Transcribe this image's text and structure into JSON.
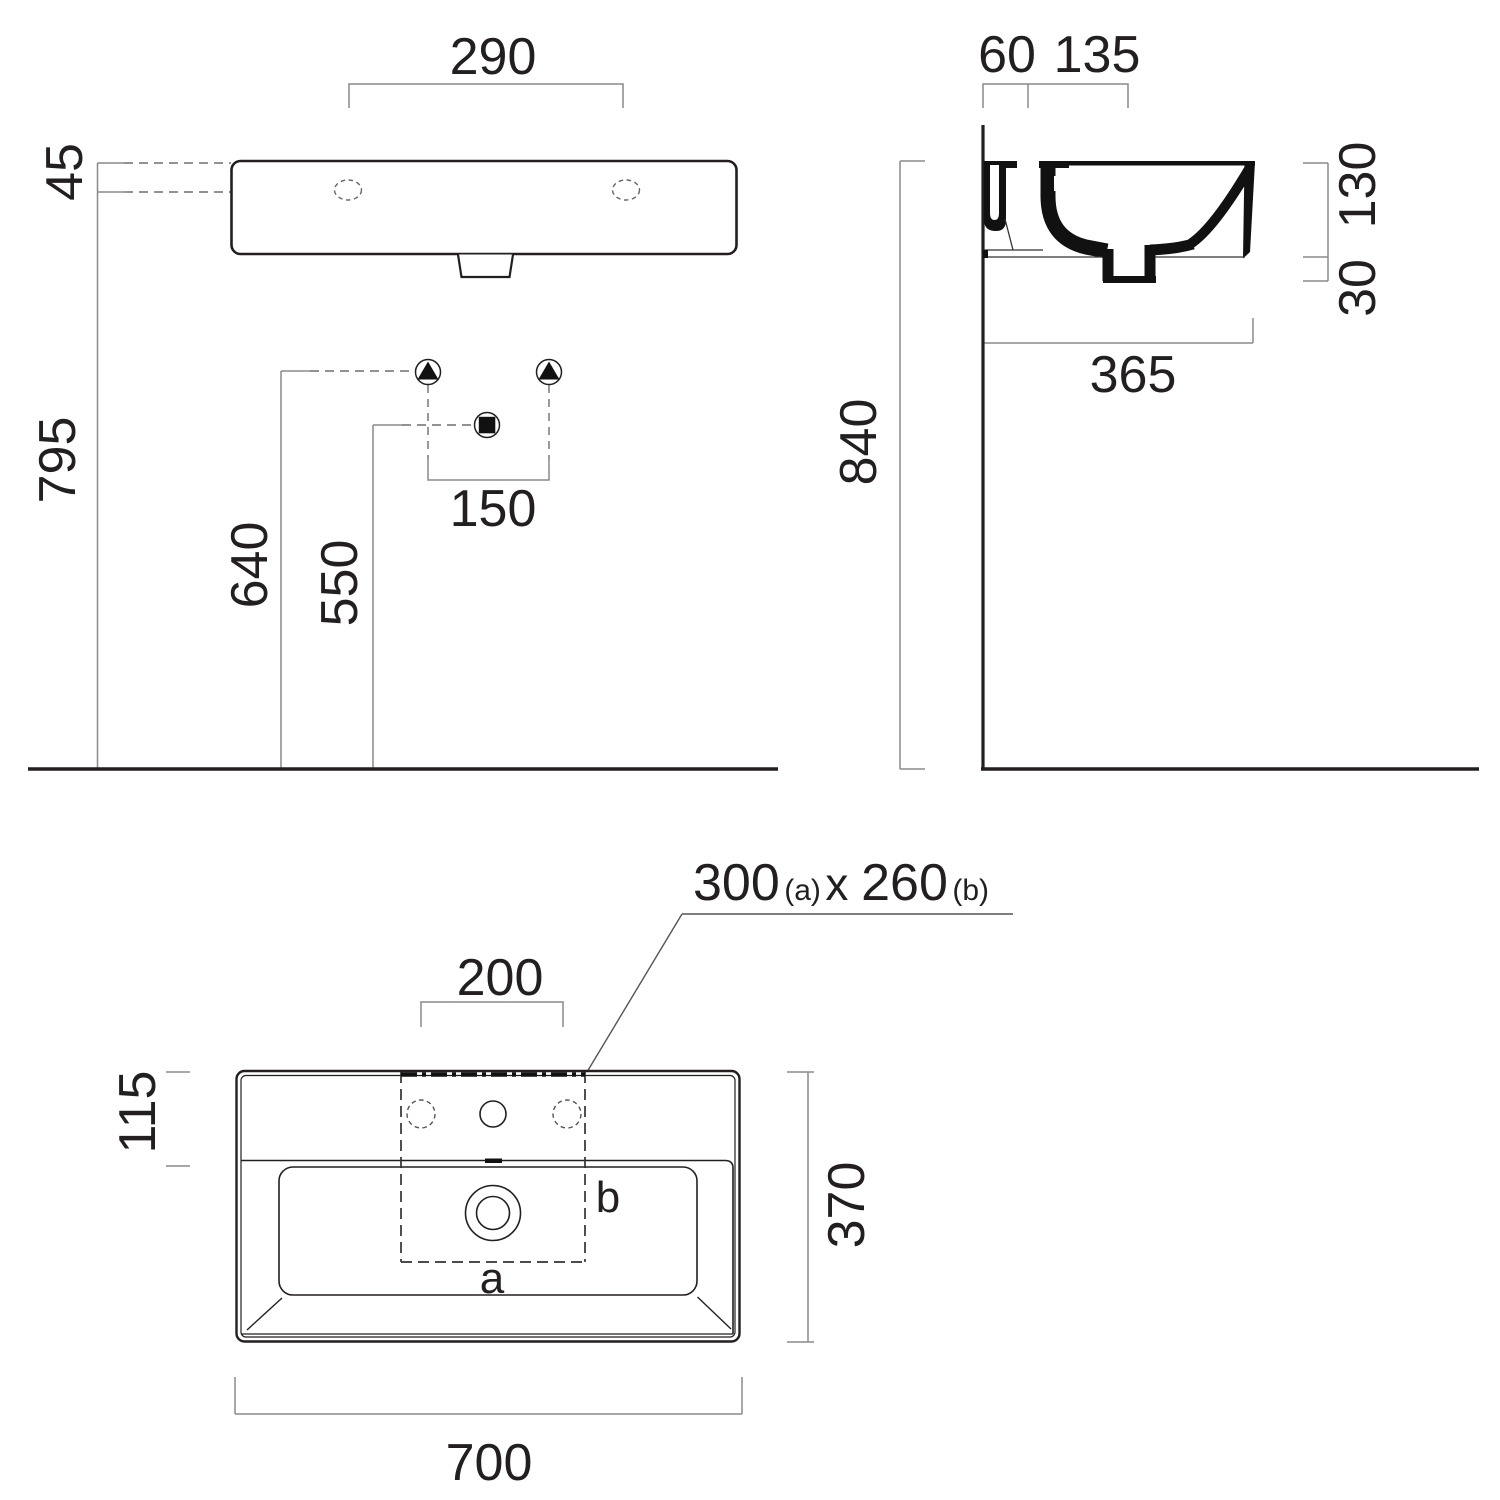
{
  "drawing_title": "Washbasin technical dimension drawing",
  "colors": {
    "ink": "#231f20",
    "fill": "#111111",
    "dim": "#8a8a8a",
    "dash": "#6e6e6e",
    "hole_dash": "#666666"
  },
  "views": {
    "front": {
      "dims": {
        "faucet_spacing": "290",
        "rim_offset": "45",
        "total_height": "795",
        "supply_height": "640",
        "drain_height": "550",
        "supply_spacing": "150"
      }
    },
    "side": {
      "dims": {
        "wall_offset": "60",
        "deck_depth": "135",
        "basin_height": "130",
        "drain_depth": "30",
        "basin_depth": "365",
        "mount_height": "840"
      }
    },
    "plan": {
      "dims": {
        "tap_spacing": "200",
        "back_ledge": "115",
        "depth": "370",
        "width": "700"
      },
      "cutout": {
        "w": "300",
        "w_sub": "(a)",
        "sep": " x ",
        "h": "260",
        "h_sub": "(b)",
        "label_a": "a",
        "label_b": "b"
      }
    }
  }
}
